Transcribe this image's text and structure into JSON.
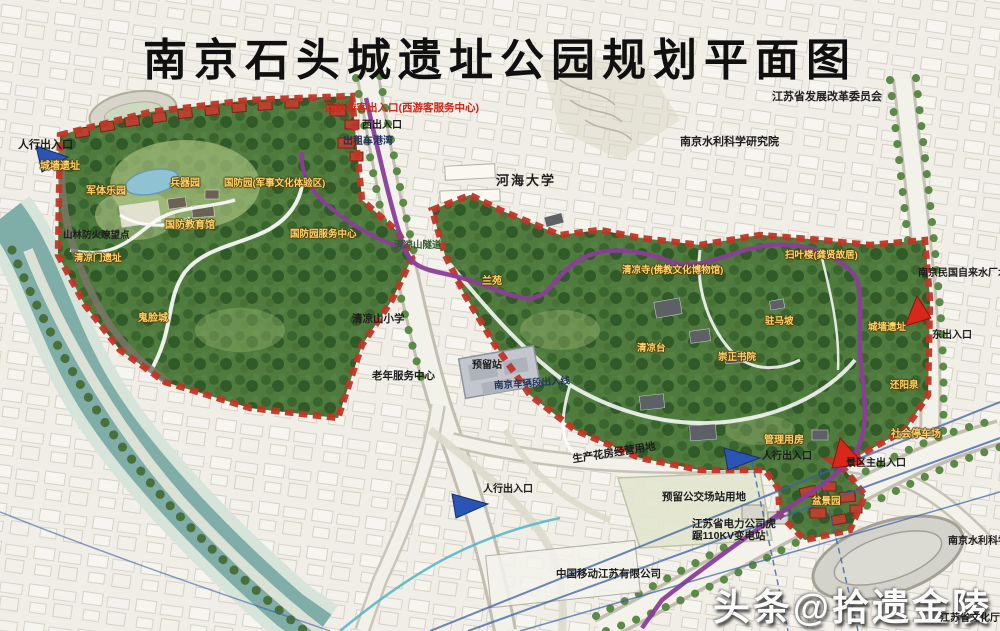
{
  "title": "南京石头城遗址公园规划平面图",
  "watermark": "头条@拾遗金陵",
  "colors": {
    "park_green": "#4e7a3e",
    "boundary_red": "#c03527",
    "metro_purple": "#8c3d99",
    "river_teal": "#7fada8",
    "label_yellow": "#ffd269",
    "entrance_blue": "#2b55b5",
    "entrance_red": "#d8281c"
  },
  "entrances": {
    "west_pedestrian": "人行出入口",
    "group_tour": "团队游客出入口(西游客服务中心)",
    "west_gate": "西出入口",
    "taxi_bay": "出租车港湾",
    "east_gate": "东出入口",
    "south_pedestrian": "人行出入口",
    "southeast_pedestrian": "人行出入口",
    "main_gate": "景区主出入口"
  },
  "surroundings": {
    "hehai_university": "河海大学",
    "jiangsu_drc": "江苏省发展改革委员会",
    "hydraulic_institute": "南京水利科学研究院",
    "hydraulic_institute_se": "南京水利科学",
    "waterworks_tower": "南京民国自来水厂水塔",
    "primary_school": "清凉山小学",
    "elderly_center": "老年服务中心",
    "reserved_station": "预留站",
    "depot_line": "南京车辆段出入线",
    "flower_land": "生产花房经营用地",
    "bus_depot_land": "预留公交场站用地",
    "substation": "江苏省电力公司虎踞110KV变电站",
    "china_mobile": "中国移动江苏有限公司",
    "culture_dept": "江苏省文化厅"
  },
  "park": {
    "wall_ruins_west": "城墙遗址",
    "military_park": "军体乐园",
    "weapons_garden": "兵器园",
    "defense_zone": "国防园(军事文化体验区)",
    "defense_hall": "国防教育馆",
    "defense_center": "国防园服务中心",
    "fire_lookout": "山林防火瞭望点",
    "qingliang_gate": "清凉门遗址",
    "ghost_face_wall": "鬼脸城",
    "tunnel": "清凉山隧道",
    "lan_garden": "兰苑",
    "qingliang_temple": "清凉寺(佛教文化博物馆)",
    "saoye_tower": "扫叶楼(龚贤故居)",
    "qingliang_terrace": "清凉台",
    "zhuma_slope": "驻马坡",
    "chongzheng_academy": "崇正书院",
    "wall_ruins_east": "城墙遗址",
    "huanyang_spring": "还阳泉",
    "bonsai_garden": "盆景园",
    "management_house": "管理用房",
    "public_parking": "社会停车场"
  }
}
